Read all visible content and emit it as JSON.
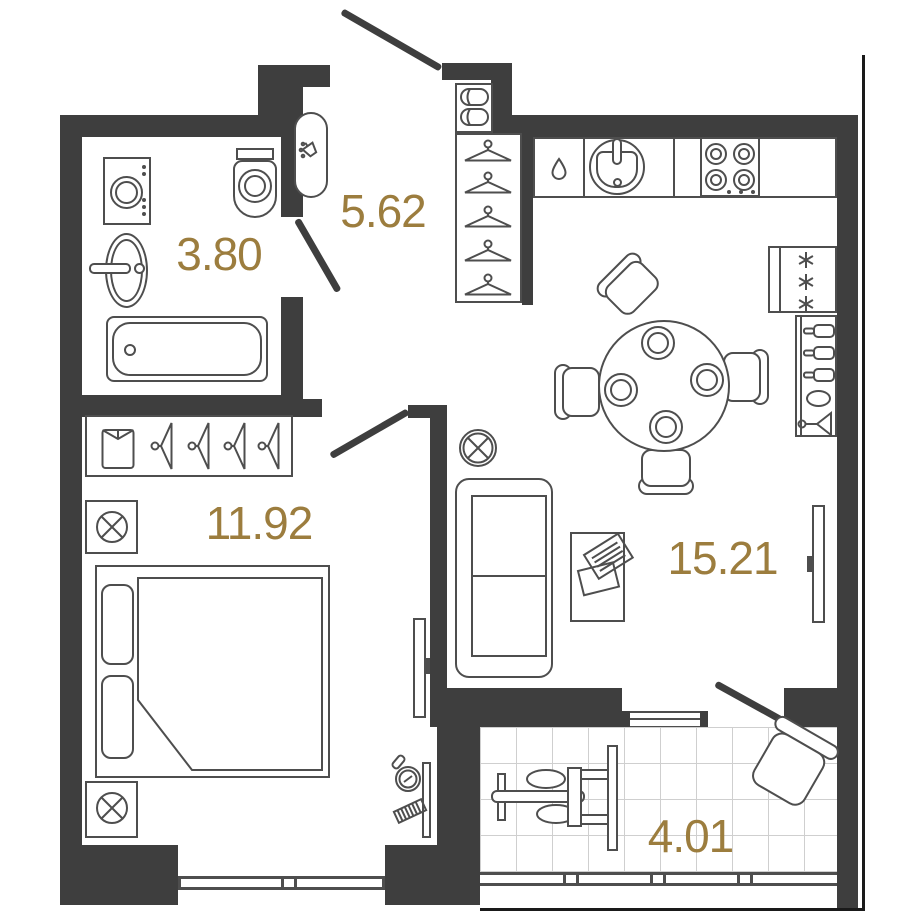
{
  "plan": {
    "title": "one-bedroom apartment floor plan",
    "area_unit": "m2",
    "colors": {
      "wall": "#3e3e3e",
      "furniture_stroke": "#4e4e4e",
      "label": "#9c7d3e",
      "tile_line": "#cfcfcf"
    },
    "rooms": [
      {
        "id": "bathroom",
        "area": "3.80",
        "furniture": [
          "washing-machine",
          "wash-basin",
          "toilet",
          "bathtub",
          "water-heater",
          "door"
        ]
      },
      {
        "id": "hallway",
        "area": "5.62",
        "furniture": [
          "entrance-door",
          "shoe-rack",
          "wardrobe-with-hangers"
        ]
      },
      {
        "id": "bedroom",
        "area": "11.92",
        "furniture": [
          "wardrobe-with-shirt-and-hangers",
          "nightstand-lamp",
          "double-bed",
          "nightstand-lamp",
          "tv",
          "vanity-mirror-comb",
          "window"
        ]
      },
      {
        "id": "kitchen-living-room",
        "area": "15.21",
        "furniture": [
          "kitchen-counter",
          "dishwasher",
          "kitchen-sink",
          "stove",
          "fridge",
          "bar-cabinet",
          "dining-table-4-plates",
          "4-chairs",
          "vent",
          "sofa",
          "coffee-table-newspaper",
          "tv",
          "window",
          "balcony-door"
        ]
      },
      {
        "id": "balcony",
        "area": "4.01",
        "furniture": [
          "exercise-machine",
          "armchair",
          "glazing"
        ]
      }
    ]
  }
}
